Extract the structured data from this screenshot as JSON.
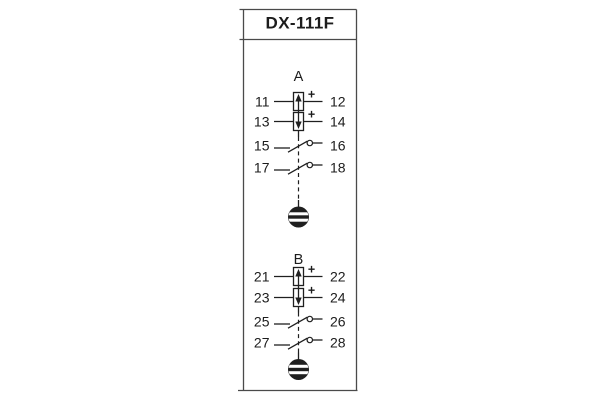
{
  "window": {
    "title": "DX-111F"
  },
  "colors": {
    "background": "#ffffff",
    "panel_border": "#4a4a4a",
    "symbol": "#1f1f1f",
    "text": "#1c1c1c"
  },
  "sections": [
    {
      "label": "A",
      "rows": [
        {
          "left": "11",
          "right": "12",
          "type": "coil",
          "arrow": "up",
          "polarity": "+"
        },
        {
          "left": "13",
          "right": "14",
          "type": "coil",
          "arrow": "down",
          "polarity": "+"
        },
        {
          "left": "15",
          "right": "16",
          "type": "contact"
        },
        {
          "left": "17",
          "right": "18",
          "type": "contact"
        }
      ],
      "indicator": "drop-flag-indicator"
    },
    {
      "label": "B",
      "rows": [
        {
          "left": "21",
          "right": "22",
          "type": "coil",
          "arrow": "up",
          "polarity": "+"
        },
        {
          "left": "23",
          "right": "24",
          "type": "coil",
          "arrow": "down",
          "polarity": "+"
        },
        {
          "left": "25",
          "right": "26",
          "type": "contact"
        },
        {
          "left": "27",
          "right": "28",
          "type": "contact"
        }
      ],
      "indicator": "drop-flag-indicator"
    }
  ]
}
